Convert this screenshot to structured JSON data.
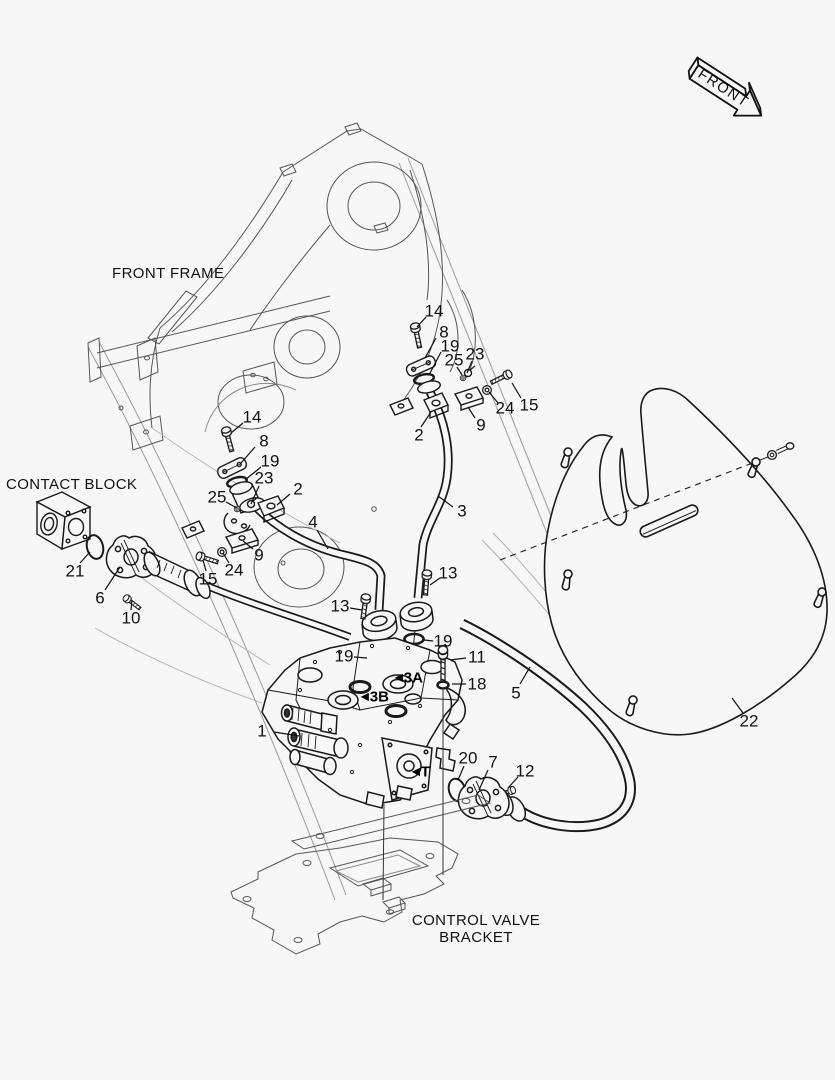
{
  "labels": {
    "front_frame": "FRONT FRAME",
    "contact_block": "CONTACT BLOCK",
    "control_valve_bracket_line1": "CONTROL VALVE",
    "control_valve_bracket_line2": "BRACKET",
    "front_arrow": "FRONT"
  },
  "port_labels": [
    {
      "text": "3A",
      "x": 409,
      "y": 678
    },
    {
      "text": "3B",
      "x": 375,
      "y": 697
    },
    {
      "text": "T",
      "x": 421,
      "y": 772
    }
  ],
  "part_labels": [
    {
      "n": "1",
      "x": 262,
      "y": 731,
      "l": [
        274,
        732,
        299,
        736
      ]
    },
    {
      "n": "2",
      "x": 419,
      "y": 435,
      "l": [
        421,
        427,
        431,
        412
      ]
    },
    {
      "n": "3",
      "x": 462,
      "y": 511,
      "l": [
        453,
        507,
        438,
        496
      ]
    },
    {
      "n": "13",
      "x": 448,
      "y": 573,
      "l": [
        440,
        578,
        430,
        585
      ]
    },
    {
      "n": "19",
      "x": 443,
      "y": 641,
      "l": [
        433,
        641,
        424,
        640
      ]
    },
    {
      "n": "11",
      "x": 477,
      "y": 657,
      "l": [
        466,
        658,
        450,
        660
      ]
    },
    {
      "n": "18",
      "x": 477,
      "y": 684,
      "l": [
        466,
        684,
        452,
        684
      ]
    },
    {
      "n": "5",
      "x": 516,
      "y": 693,
      "l": [
        520,
        684,
        530,
        667
      ]
    },
    {
      "n": "20",
      "x": 468,
      "y": 758,
      "l": [
        464,
        766,
        458,
        780
      ]
    },
    {
      "n": "7",
      "x": 493,
      "y": 762,
      "l": [
        488,
        770,
        479,
        790
      ]
    },
    {
      "n": "12",
      "x": 525,
      "y": 771,
      "l": [
        518,
        777,
        508,
        788
      ]
    },
    {
      "n": "22",
      "x": 749,
      "y": 721,
      "l": [
        743,
        713,
        732,
        698
      ]
    },
    {
      "n": "14",
      "x": 434,
      "y": 311,
      "l": [
        426,
        317,
        417,
        327
      ]
    },
    {
      "n": "8",
      "x": 444,
      "y": 332,
      "l": [
        436,
        338,
        425,
        358
      ]
    },
    {
      "n": "19",
      "x": 450,
      "y": 346,
      "l": [
        441,
        352,
        429,
        375
      ]
    },
    {
      "n": "25",
      "x": 454,
      "y": 360,
      "l": [
        457,
        367,
        462,
        375
      ]
    },
    {
      "n": "23",
      "x": 475,
      "y": 354,
      "l": [
        472,
        361,
        467,
        373
      ]
    },
    {
      "n": "24",
      "x": 505,
      "y": 408,
      "l": [
        498,
        403,
        489,
        392
      ]
    },
    {
      "n": "15",
      "x": 529,
      "y": 405,
      "l": [
        521,
        398,
        512,
        383
      ]
    },
    {
      "n": "9",
      "x": 481,
      "y": 425,
      "l": [
        475,
        418,
        468,
        407
      ]
    },
    {
      "n": "14",
      "x": 252,
      "y": 417,
      "l": [
        243,
        423,
        231,
        433
      ]
    },
    {
      "n": "8",
      "x": 264,
      "y": 441,
      "l": [
        255,
        447,
        241,
        463
      ]
    },
    {
      "n": "19",
      "x": 270,
      "y": 461,
      "l": [
        261,
        467,
        245,
        480
      ]
    },
    {
      "n": "23",
      "x": 264,
      "y": 478,
      "l": [
        259,
        486,
        251,
        504
      ]
    },
    {
      "n": "2",
      "x": 298,
      "y": 489,
      "l": [
        290,
        494,
        277,
        505
      ]
    },
    {
      "n": "25",
      "x": 217,
      "y": 497,
      "l": [
        226,
        502,
        237,
        508
      ]
    },
    {
      "n": "4",
      "x": 313,
      "y": 522,
      "l": [
        317,
        530,
        328,
        549
      ]
    },
    {
      "n": "9",
      "x": 259,
      "y": 555,
      "l": [
        253,
        549,
        243,
        541
      ]
    },
    {
      "n": "24",
      "x": 234,
      "y": 570,
      "l": [
        229,
        563,
        223,
        553
      ]
    },
    {
      "n": "15",
      "x": 208,
      "y": 579,
      "l": [
        206,
        571,
        203,
        560
      ]
    },
    {
      "n": "13",
      "x": 340,
      "y": 606,
      "l": [
        350,
        608,
        362,
        610
      ]
    },
    {
      "n": "19",
      "x": 344,
      "y": 656,
      "l": [
        354,
        657,
        367,
        658
      ]
    },
    {
      "n": "21",
      "x": 75,
      "y": 571,
      "l": [
        80,
        563,
        90,
        552
      ]
    },
    {
      "n": "6",
      "x": 100,
      "y": 598,
      "l": [
        105,
        590,
        120,
        567
      ]
    },
    {
      "n": "10",
      "x": 131,
      "y": 618,
      "l": [
        131,
        610,
        132,
        600
      ]
    }
  ],
  "colors": {
    "line": "#1a1a1a",
    "light_line": "#999999",
    "background": "#f7f7f7"
  }
}
